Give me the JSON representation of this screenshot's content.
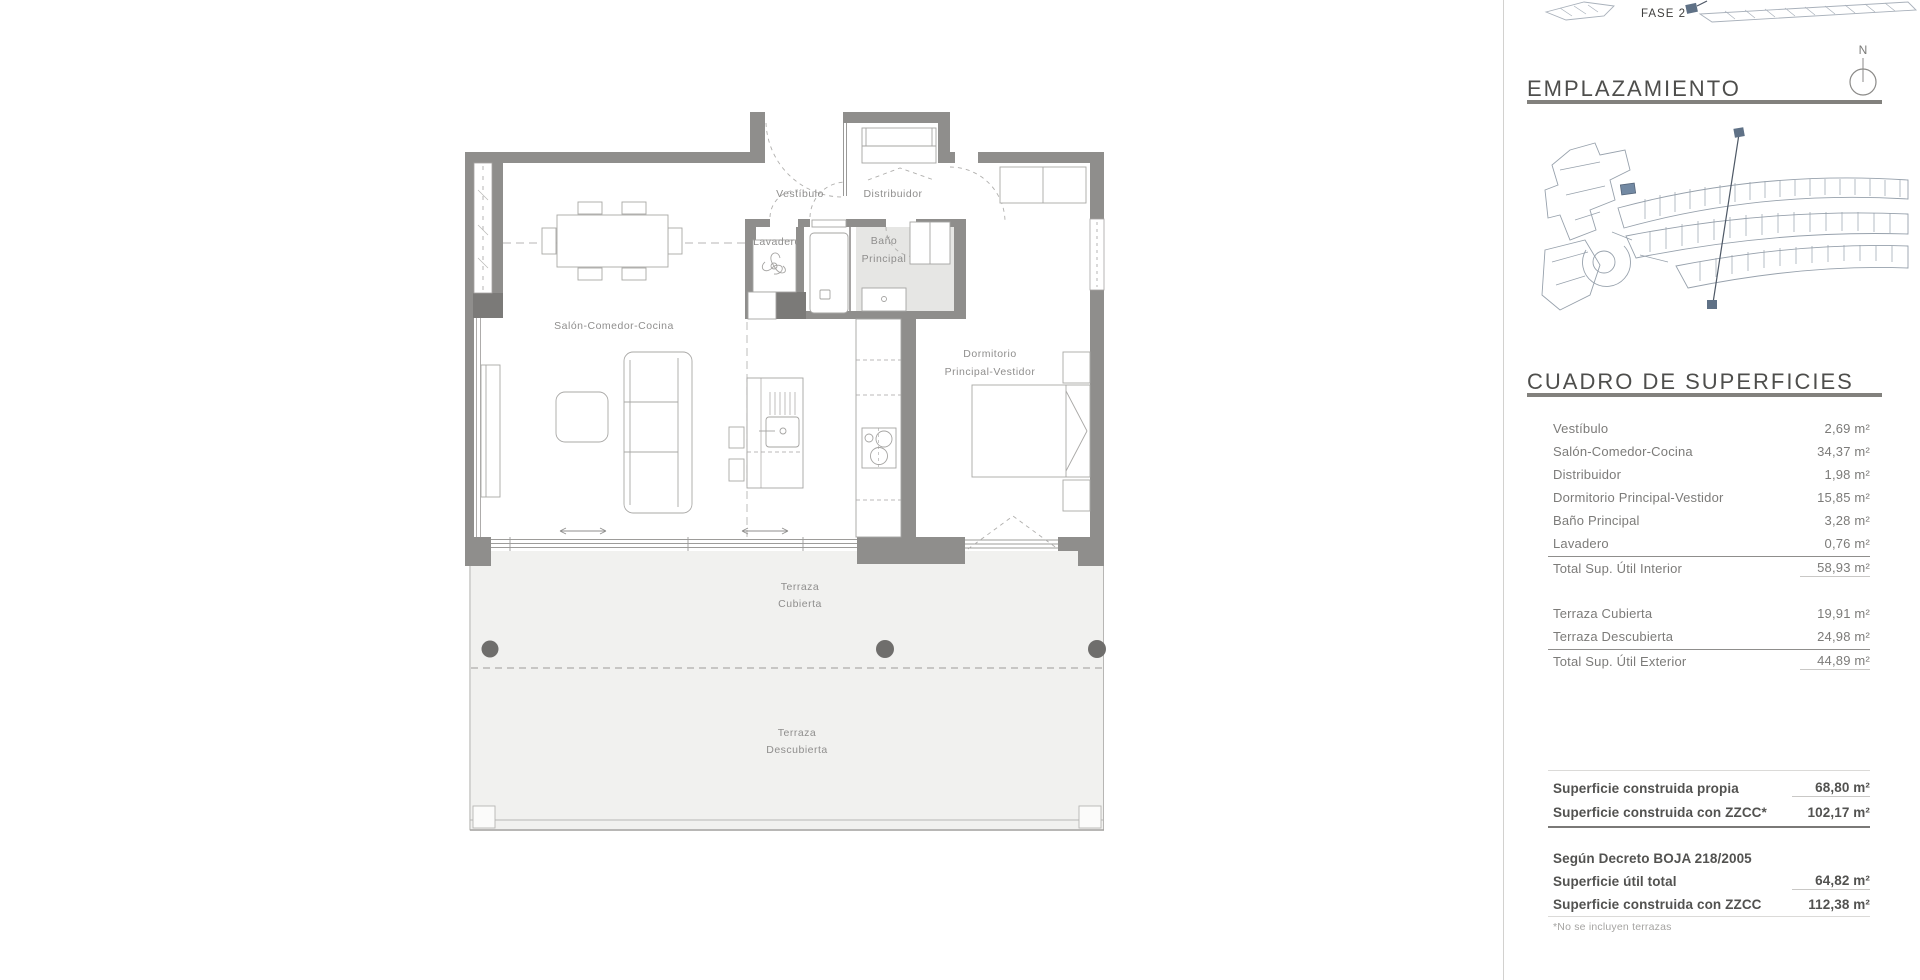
{
  "floor_plan": {
    "rooms": {
      "vestibulo": "Vestíbulo",
      "distribuidor": "Distribuidor",
      "lavadero": "Lavadero",
      "bano": [
        "Baño",
        "Principal"
      ],
      "salon": "Salón-Comedor-Cocina",
      "dormitorio": [
        "Dormitorio",
        "Principal-Vestidor"
      ],
      "terraza_cubierta": [
        "Terraza",
        "Cubierta"
      ],
      "terraza_descubierta": [
        "Terraza",
        "Descubierta"
      ]
    }
  },
  "sidebar": {
    "fase2_top_label": "FASE 2",
    "compass_label": "N",
    "emplazamiento": {
      "title": "EMPLAZAMIENTO",
      "fase1_label": "FASE 1",
      "fase2_label": "FASE 2"
    },
    "superficies": {
      "title": "CUADRO DE SUPERFICIES",
      "interior": {
        "rows": [
          {
            "label": "Vestíbulo",
            "value": "2,69 m²"
          },
          {
            "label": "Salón-Comedor-Cocina",
            "value": "34,37 m²"
          },
          {
            "label": "Distribuidor",
            "value": "1,98 m²"
          },
          {
            "label": "Dormitorio Principal-Vestidor",
            "value": "15,85 m²"
          },
          {
            "label": "Baño Principal",
            "value": "3,28 m²"
          },
          {
            "label": "Lavadero",
            "value": "0,76 m²"
          }
        ],
        "total": {
          "label": "Total Sup. Útil Interior",
          "value": "58,93 m²"
        }
      },
      "exterior": {
        "rows": [
          {
            "label": "Terraza Cubierta",
            "value": "19,91 m²"
          },
          {
            "label": "Terraza Descubierta",
            "value": "24,98 m²"
          }
        ],
        "total": {
          "label": "Total Sup. Útil Exterior",
          "value": "44,89 m²"
        }
      },
      "construida": {
        "rows": [
          {
            "label": "Superficie construida propia",
            "value": "68,80 m²"
          },
          {
            "label": "Superficie construida con ZZCC*",
            "value": "102,17 m²"
          }
        ]
      },
      "decreto": {
        "heading": "Según Decreto BOJA 218/2005",
        "rows": [
          {
            "label": "Superficie útil total",
            "value": "64,82 m²"
          },
          {
            "label": "Superficie construida con ZZCC",
            "value": "112,38 m²"
          }
        ]
      },
      "footnote": "*No se incluyen terrazas"
    }
  },
  "colors": {
    "wall": "#8f8e8c",
    "wall_dark": "#7b7a78",
    "column": "#6f6e6c",
    "terrace_floor": "#f1f1ef",
    "bath_floor": "#e6e6e4",
    "highlight_unit": "#7289a3",
    "heading_text": "#4e4e4c",
    "table_text": "#7c7b79"
  }
}
